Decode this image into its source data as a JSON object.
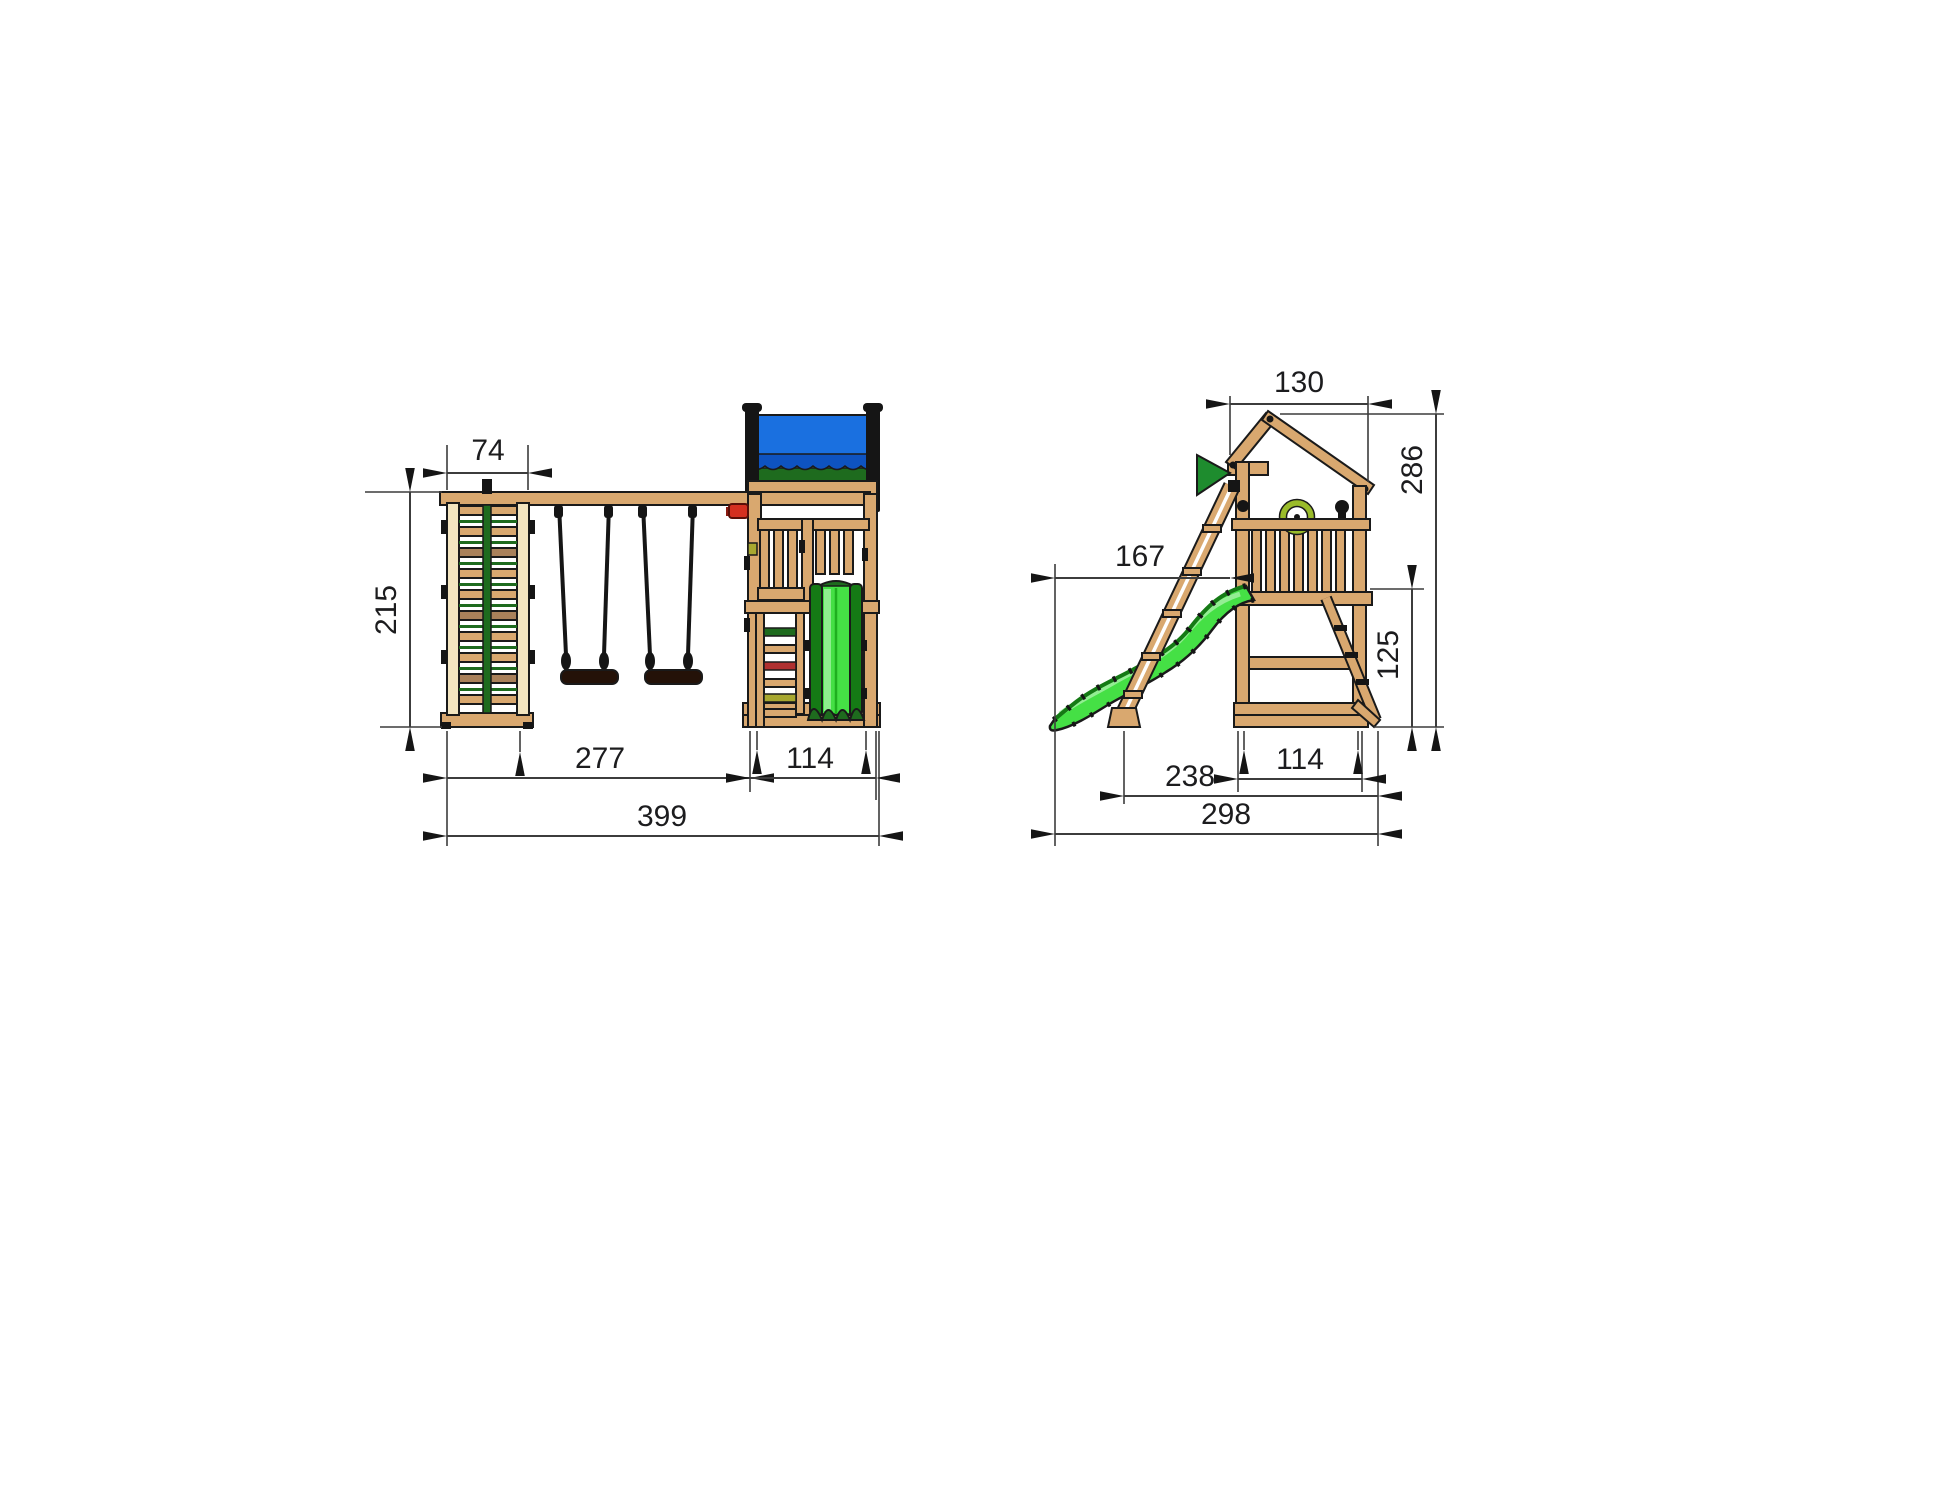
{
  "front_view": {
    "dimensions": {
      "climb_width": "74",
      "height": "215",
      "swing_span": "277",
      "tower_width": "114",
      "total_width": "399"
    }
  },
  "side_view": {
    "dimensions": {
      "roof_depth": "130",
      "total_height": "286",
      "slide_reach": "167",
      "platform_height": "125",
      "base_depth": "238",
      "tower_depth": "114",
      "total_depth": "298"
    }
  },
  "colors": {
    "wood": "#D9A86F",
    "wood_light": "#F3E5C0",
    "wood_dark": "#A9815A",
    "outline": "#1a1a1a",
    "dim_line": "#3c3c3c",
    "text": "#1c1c1e",
    "tarp_blue": "#1A70E0",
    "tarp_blue_dark": "#0E53C0",
    "green_dark": "#1E6B1E",
    "slide_green": "#45E045",
    "slide_green_dark": "#157A15",
    "slide_highlight": "#9BF09B",
    "flag_green": "#1E8C2E",
    "seat_brown": "#241208",
    "logo_red": "#D43020",
    "rung_red": "#B03030",
    "rung_yellow": "#A8A830",
    "wheel_green": "#9ABB2A"
  }
}
